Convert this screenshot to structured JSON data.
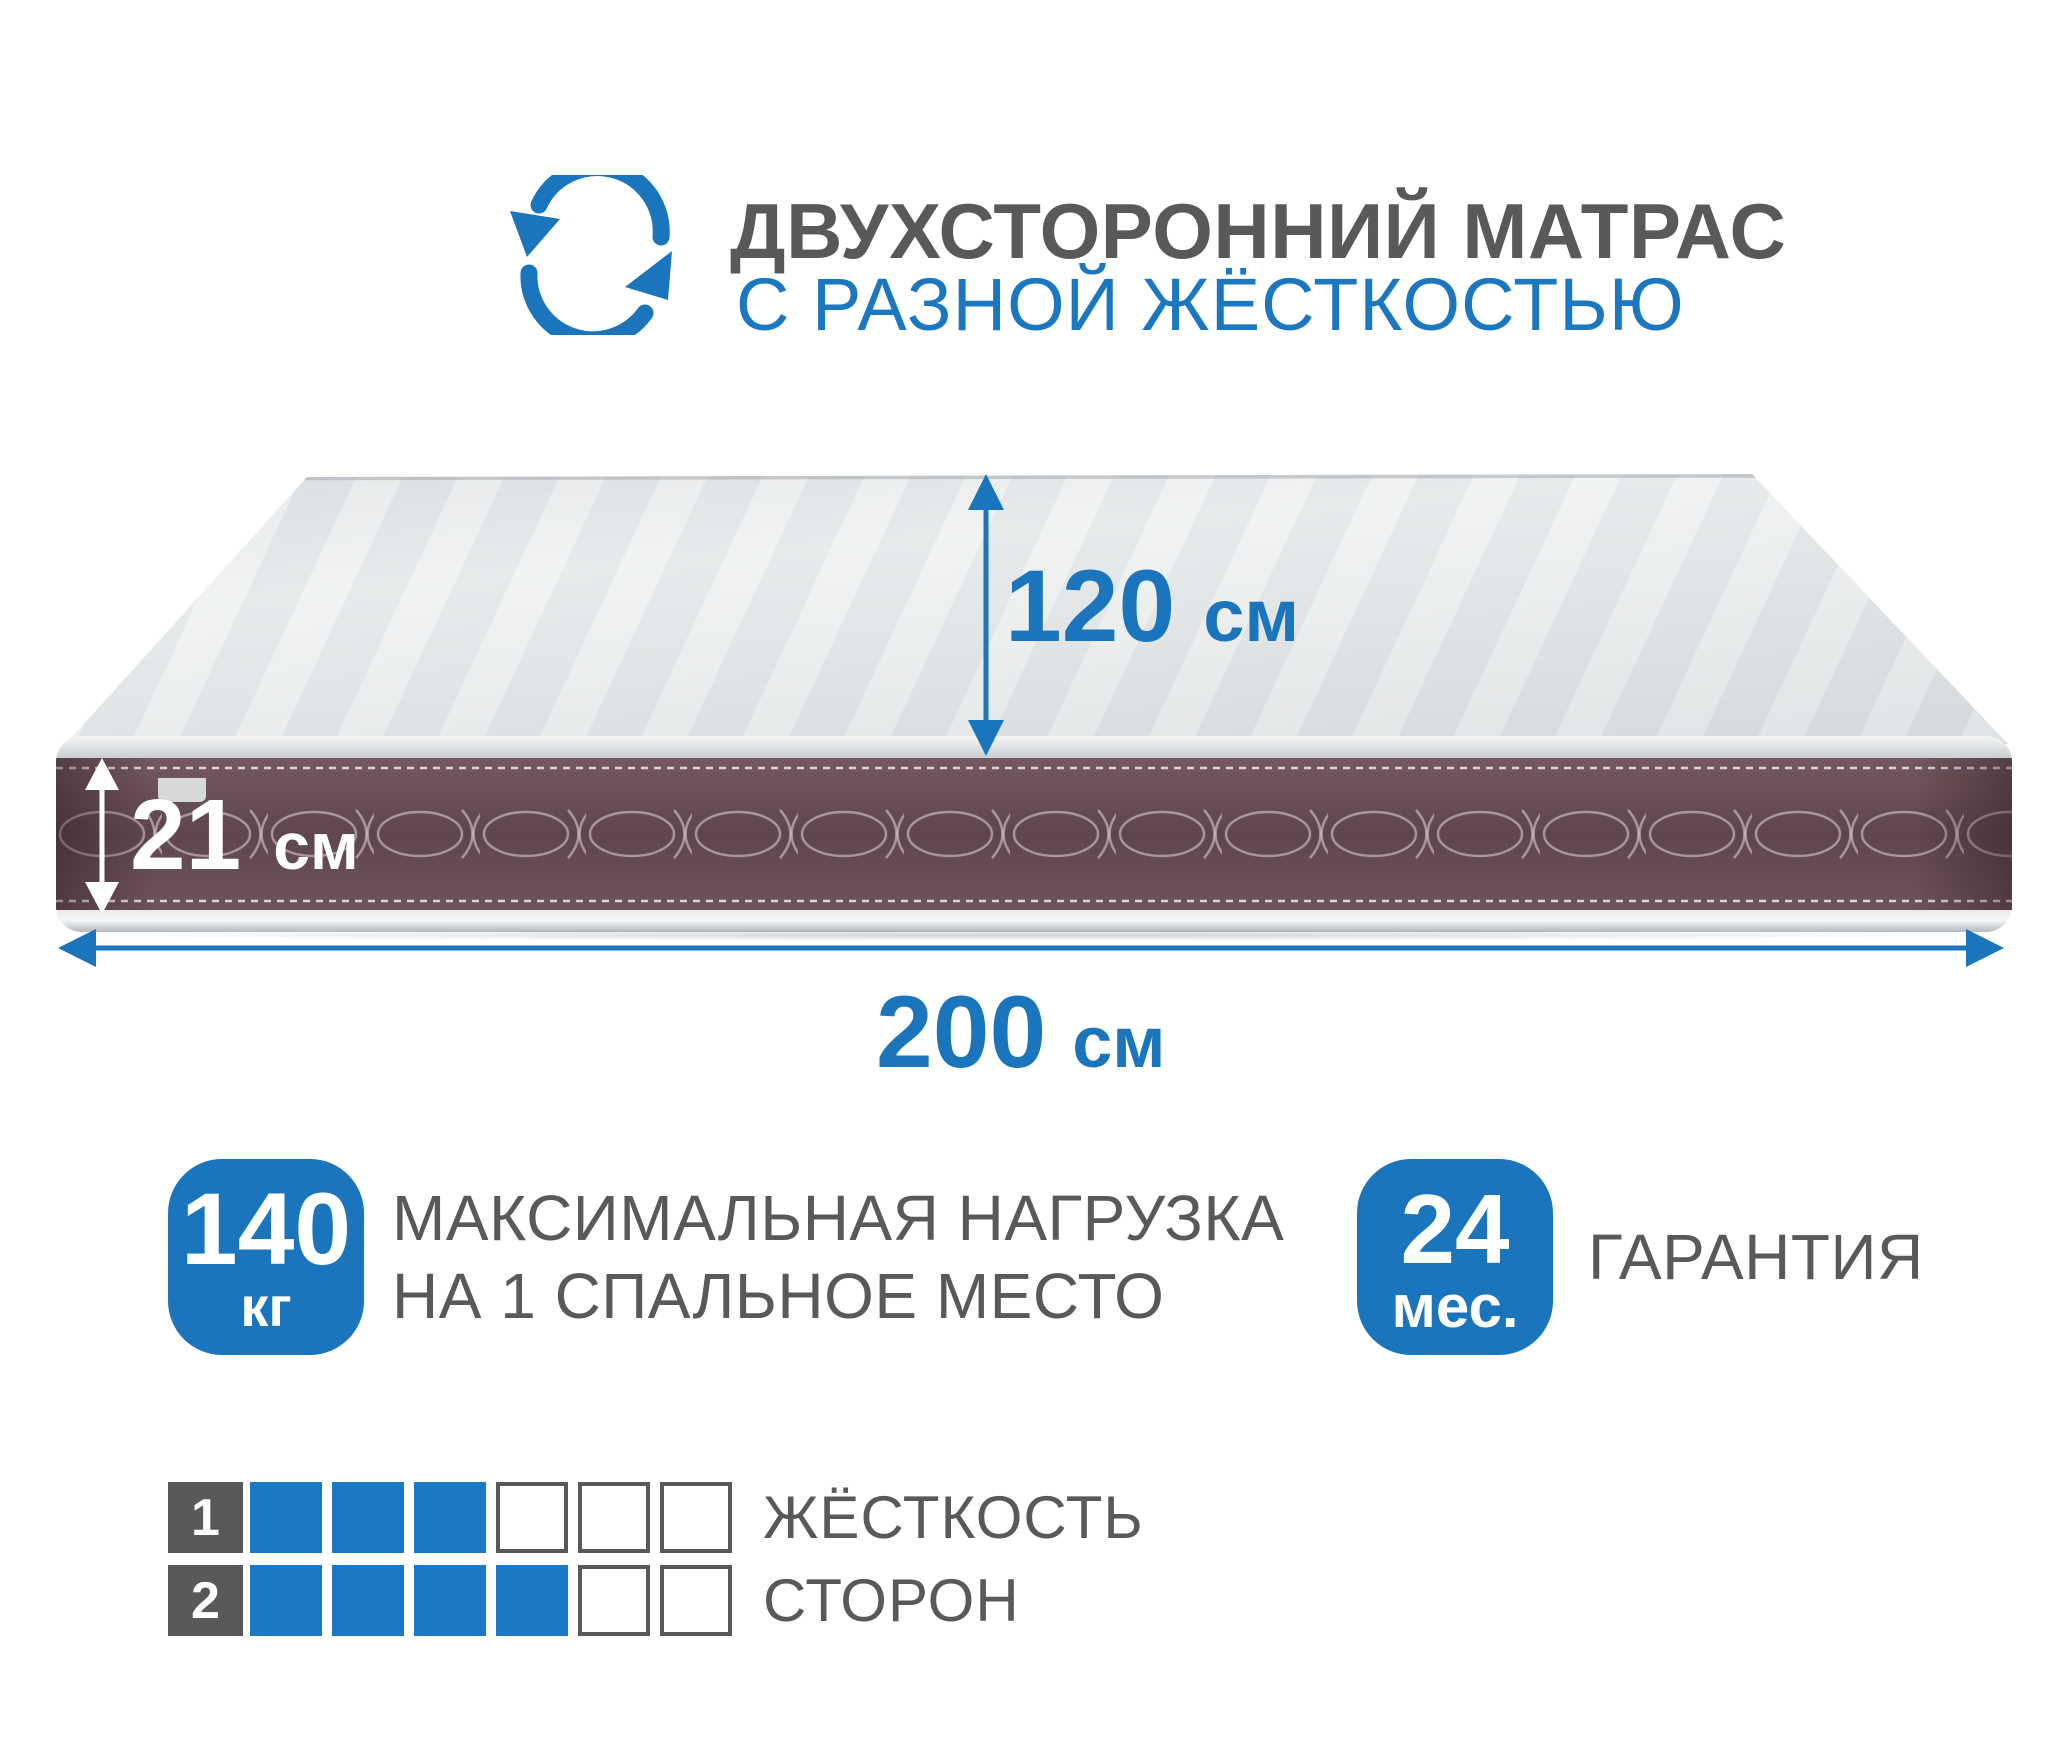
{
  "header": {
    "title": "ДВУХСТОРОННИЙ МАТРАС",
    "subtitle": "С РАЗНОЙ ЖЁСТКОСТЬЮ",
    "icon": "rotate-arrows-icon"
  },
  "dimensions": {
    "depth": {
      "value": "120",
      "unit": "см"
    },
    "thickness": {
      "value": "21",
      "unit": "см"
    },
    "width": {
      "value": "200",
      "unit": "см"
    }
  },
  "badges": {
    "max_load": {
      "value": "140",
      "unit": "кг",
      "label_line1": "МАКСИМАЛЬНАЯ НАГРУЗКА",
      "label_line2": "НА 1 СПАЛЬНОЕ МЕСТО"
    },
    "warranty": {
      "value": "24",
      "unit": "мес.",
      "label": "ГАРАНТИЯ"
    }
  },
  "firmness": {
    "rows": [
      {
        "num": "1",
        "filled": 3,
        "total": 6
      },
      {
        "num": "2",
        "filled": 4,
        "total": 6
      }
    ],
    "label_line1": "ЖЁСТКОСТЬ",
    "label_line2": "СТОРОН"
  },
  "colors": {
    "accent_blue": "#1b75bc",
    "text_gray": "#58595b",
    "band_brown": "#5f464d",
    "square_blue": "#1b78c4"
  }
}
